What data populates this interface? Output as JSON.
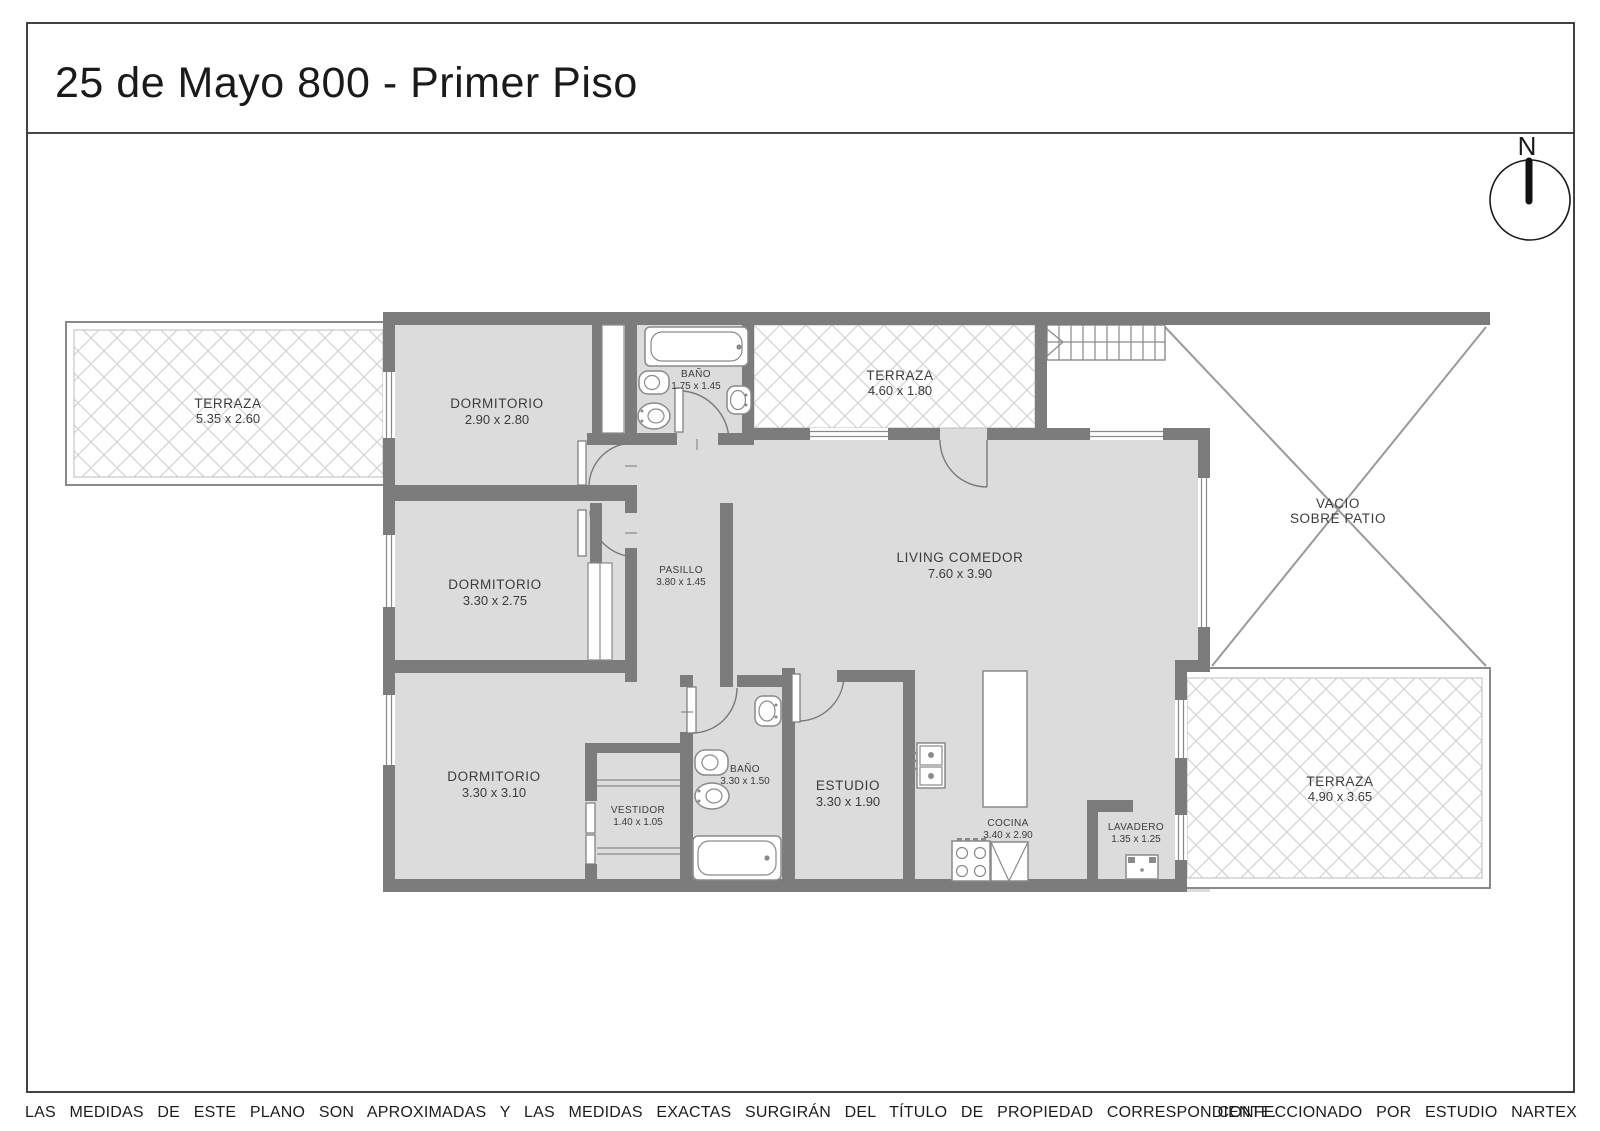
{
  "title": "25 de Mayo 800 - Primer Piso",
  "compass": {
    "north_label": "N"
  },
  "rooms": {
    "terraza_izquierda": {
      "name": "TERRAZA",
      "dims": "5.35 x 2.60"
    },
    "dormitorio_1": {
      "name": "DORMITORIO",
      "dims": "2.90 x 2.80"
    },
    "banio_1": {
      "name": "BAÑO",
      "dims": "1.75 x 1.45"
    },
    "terraza_superior": {
      "name": "TERRAZA",
      "dims": "4.60 x 1.80"
    },
    "vacio": {
      "name": "VACIO",
      "dims": "SOBRE PATIO"
    },
    "dormitorio_2": {
      "name": "DORMITORIO",
      "dims": "3.30 x 2.75"
    },
    "pasillo": {
      "name": "PASILLO",
      "dims": "3.80 x 1.45"
    },
    "living_comedor": {
      "name": "LIVING COMEDOR",
      "dims": "7.60 x 3.90"
    },
    "dormitorio_3": {
      "name": "DORMITORIO",
      "dims": "3.30 x 3.10"
    },
    "vestidor": {
      "name": "VESTIDOR",
      "dims": "1.40 x 1.05"
    },
    "banio_2": {
      "name": "BAÑO",
      "dims": "3.30 x 1.50"
    },
    "estudio": {
      "name": "ESTUDIO",
      "dims": "3.30 x 1.90"
    },
    "cocina": {
      "name": "COCINA",
      "dims": "3.40 x 2.90"
    },
    "lavadero": {
      "name": "LAVADERO",
      "dims": "1.35 x 1.25"
    },
    "terraza_inferior": {
      "name": "TERRAZA",
      "dims": "4.90 x 3.65"
    }
  },
  "footer": {
    "disclaimer": "LAS MEDIDAS DE ESTE PLANO SON APROXIMADAS Y LAS MEDIDAS EXACTAS SURGIRÁN DEL TÍTULO DE PROPIEDAD CORRESPONDIENTE.",
    "credit": "CONFECCIONADO POR ESTUDIO NARTEX"
  },
  "colors": {
    "wall": "#7c7c7c",
    "floor": "#dcdcdc",
    "line": "#8a8a8a",
    "hatch": "#d2d2d2",
    "ink": "#1a1a1a",
    "label": "#3c3c3c",
    "frame": "#2e2e2e"
  }
}
